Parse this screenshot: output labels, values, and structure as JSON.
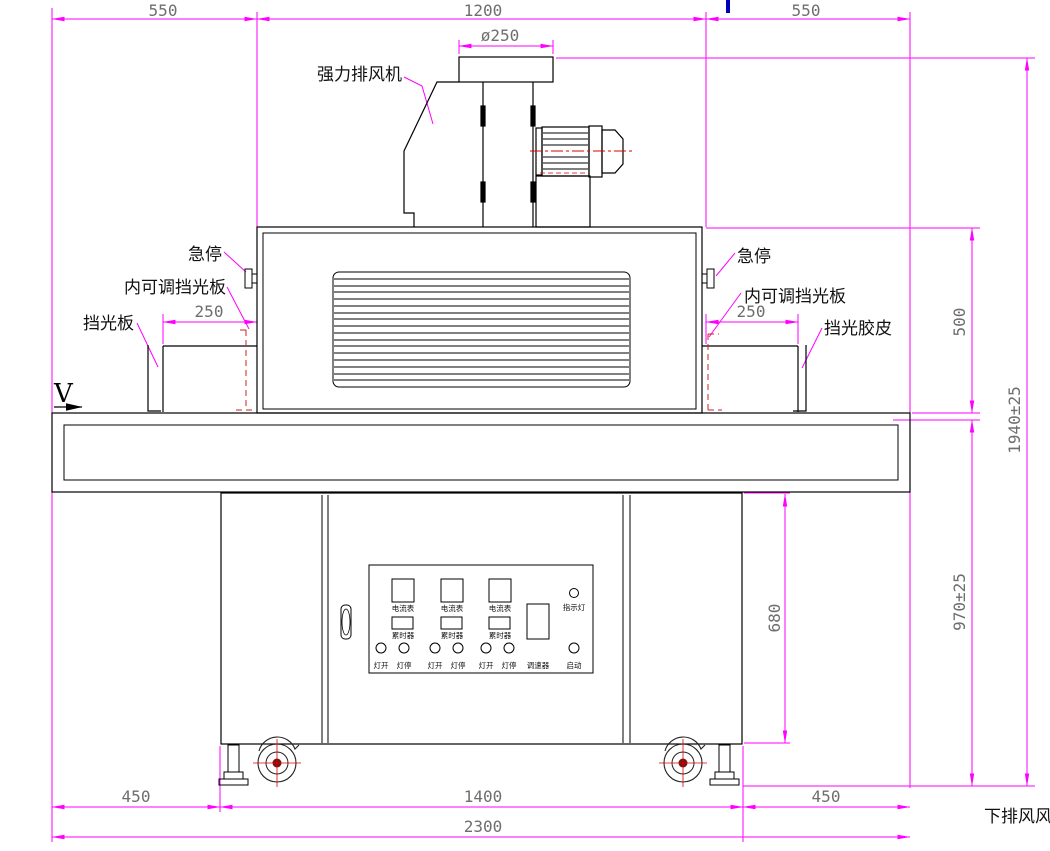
{
  "dimensions": {
    "top": [
      "550",
      "1200",
      "550"
    ],
    "flange_diameter": "ø250",
    "tunnel_left": "250",
    "tunnel_right": "250",
    "chamber_height": "500",
    "overall_height": "1940±25",
    "work_height": "970±25",
    "cabinet_height": "680",
    "bottom": [
      "450",
      "1400",
      "450"
    ],
    "overall_width": "2300"
  },
  "callouts": {
    "exhaust_fan": "强力排风机",
    "estop_left": "急停",
    "estop_right": "急停",
    "adj_shield_left": "内可调挡光板",
    "adj_shield_right": "内可调挡光板",
    "shield_left": "挡光板",
    "shield_rubber_right": "挡光胶皮",
    "bottom_exhaust": "下排风风",
    "direction": "V"
  },
  "panel": {
    "ammeters": [
      "电流表",
      "电流表",
      "电流表"
    ],
    "timers": [
      "累时器",
      "累时器",
      "累时器"
    ],
    "indicator": "指示灯",
    "buttons": [
      "灯开",
      "灯停",
      "灯开",
      "灯停",
      "灯开",
      "灯停"
    ],
    "speed": "调速器",
    "start": "启动"
  },
  "colors": {
    "dimension": "#ff00ff",
    "outline": "#000000",
    "hidden_line": "#cc2222",
    "centerline": "#dd0000",
    "dim_text": "#6e6e6e",
    "blue_mark": "#0000bb"
  }
}
